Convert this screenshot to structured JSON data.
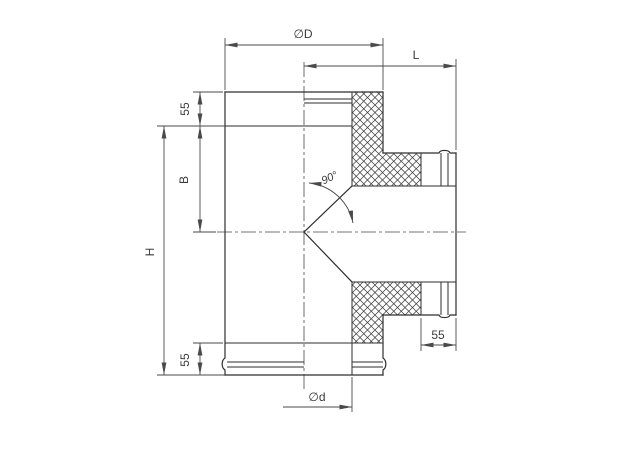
{
  "colors": {
    "bg": "#ffffff",
    "line": "#2e2e2e",
    "dim": "#4a4a4a",
    "text": "#3a3a3a",
    "hatch": "#3a3a3a"
  },
  "labels": {
    "outer_diameter": "∅D",
    "branch_length": "L",
    "top_socket": "55",
    "branch_offset": "B",
    "total_height": "H",
    "branch_angle": "90°",
    "bottom_socket": "55",
    "branch_end_socket": "55",
    "inner_diameter": "∅d"
  }
}
